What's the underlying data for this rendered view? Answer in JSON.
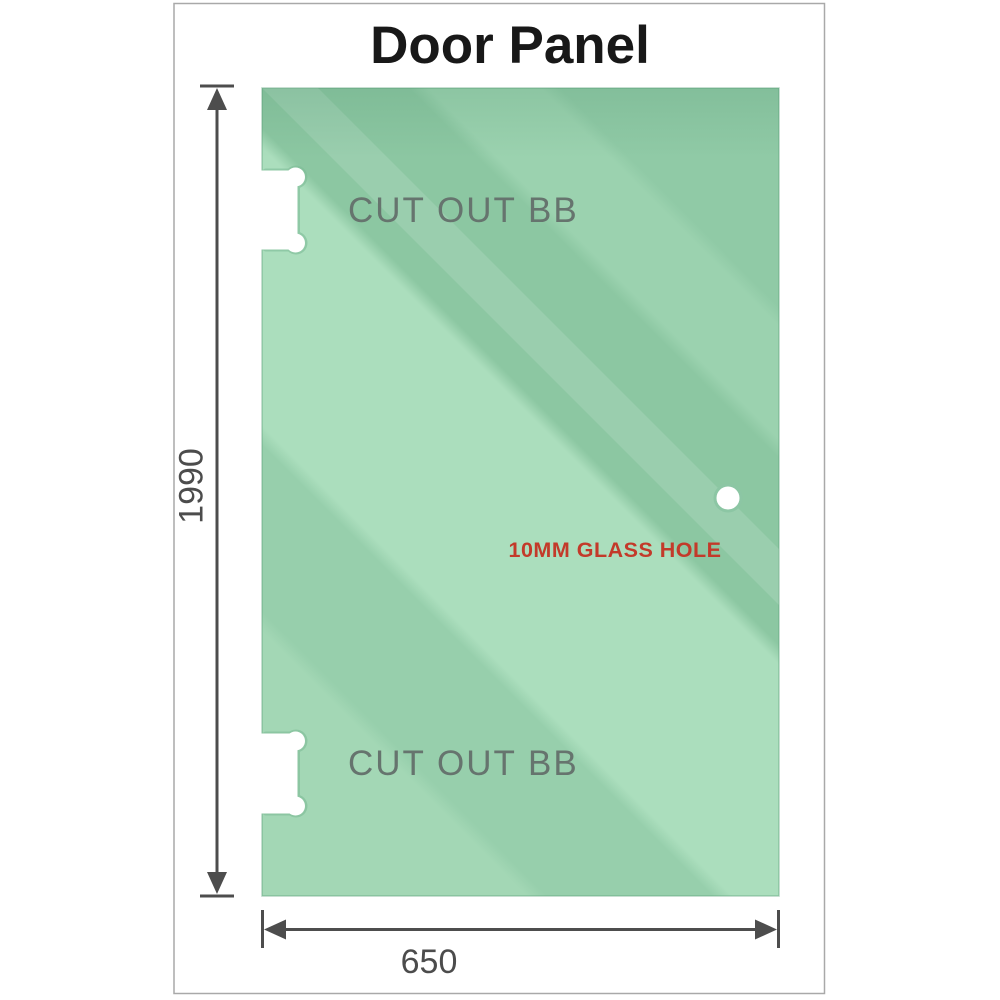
{
  "title": "Door Panel",
  "panel": {
    "material": "glass",
    "cutouts": [
      {
        "label": "CUT OUT BB",
        "position": "top-left"
      },
      {
        "label": "CUT OUT BB",
        "position": "bottom-left"
      }
    ],
    "hole": {
      "label": "10MM GLASS HOLE",
      "diameter_mm": 10
    },
    "glass_gradient": [
      {
        "offset": "0.00",
        "color": "#a3d7b5"
      },
      {
        "offset": "0.20",
        "color": "#a3d7b5"
      },
      {
        "offset": "0.215",
        "color": "#97cfac"
      },
      {
        "offset": "0.34",
        "color": "#97cfac"
      },
      {
        "offset": "0.355",
        "color": "#abdebd"
      },
      {
        "offset": "0.565",
        "color": "#abdebd"
      },
      {
        "offset": "0.58",
        "color": "#8cc7a2"
      },
      {
        "offset": "0.72",
        "color": "#8cc7a2"
      },
      {
        "offset": "0.735",
        "color": "#9bd2af"
      },
      {
        "offset": "0.82",
        "color": "#9bd2af"
      },
      {
        "offset": "0.835",
        "color": "#90caa6"
      },
      {
        "offset": "1.00",
        "color": "#90caa6"
      }
    ],
    "colors": {
      "glass_base": "#8cc7a2",
      "glass_light": "#abdebd",
      "cutout_rim": "#7ebc97",
      "hole_ring": "#8cc6a4"
    }
  },
  "dimensions": {
    "height": {
      "value": "1990",
      "orientation": "vertical"
    },
    "width": {
      "value": "650",
      "orientation": "horizontal"
    }
  },
  "colors": {
    "title_text": "#181818",
    "cutout_label_gray": "#66746e",
    "hole_label_red": "#c33a2a",
    "dimension_gray": "#4c4c4c",
    "frame_border": "#a9a9a9"
  }
}
